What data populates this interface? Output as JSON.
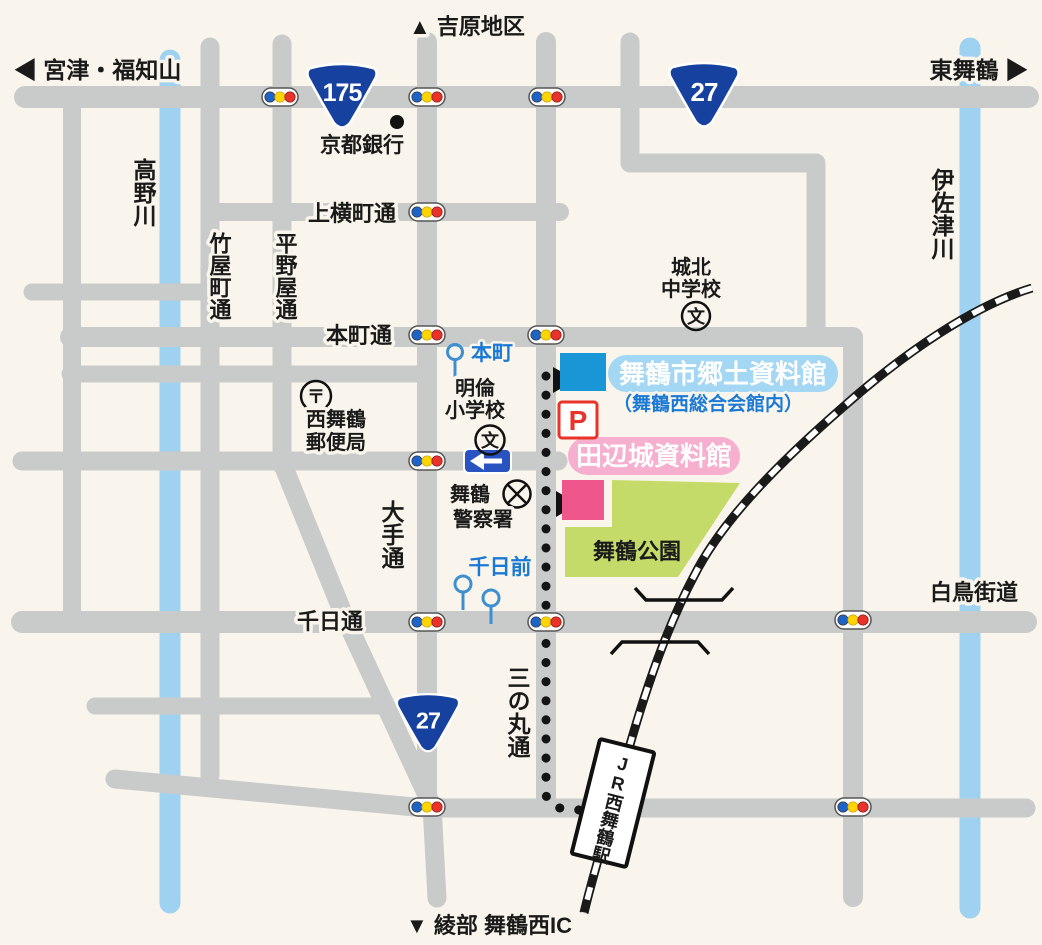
{
  "colors": {
    "background": "#FAF5EC",
    "road_gray": "#C8CBC9",
    "river_blue": "#9ED2F0",
    "park_green": "#C4DB69",
    "railway_black": "#1A1A1A",
    "museum_blue_building": "#1996D5",
    "museum_blue_pill": "#A3D7F3",
    "museum_note_blue": "#1B79D6",
    "tanabe_pink_building": "#EF568C",
    "tanabe_pink_pill": "#F6AFCF",
    "parking_red": "#E8332A",
    "route_shield_blue": "#17419E",
    "signal_blue": "#1E63C8",
    "signal_yellow": "#FFD400",
    "signal_red": "#E8332A",
    "oneway_sign_blue": "#2853C0",
    "tram_stop_blue": "#3E8FD0",
    "label_text": "#1A1A1A"
  },
  "directions": {
    "north": "▲ 吉原地区",
    "west": "◀ 宮津・福知山",
    "east": "東舞鶴 ▶",
    "south": "▼ 綾部 舞鶴西IC"
  },
  "route_shields": {
    "route175": "175",
    "route27_top": "27",
    "route27_bottom": "27"
  },
  "rivers": {
    "takano": "高野川",
    "isazu": "伊佐津川"
  },
  "streets": {
    "kamiyokocho": "上横町通",
    "honmachi": "本町通",
    "takeyacho": "竹屋町通",
    "hiranoya": "平野屋通",
    "ote": "大手通",
    "sennichi": "千日通",
    "sannomaru": "三の丸通",
    "shiratori": "白鳥街道"
  },
  "tram_stops": {
    "honmachi": "本町",
    "sennichimae": "千日前"
  },
  "landmarks": {
    "kyoto_bank": "京都銀行",
    "post_office": [
      "西舞鶴",
      "郵便局"
    ],
    "post_symbol": "〒",
    "meirin_school": [
      "明倫",
      "小学校"
    ],
    "school_symbol": "文",
    "police": [
      "舞鶴",
      "警察署"
    ],
    "johoku_school": [
      "城北",
      "中学校"
    ],
    "park": "舞鶴公園",
    "station": "JR西舞鶴駅"
  },
  "museums": {
    "kyodo_label": "舞鶴市郷土資料館",
    "kyodo_note": "（舞鶴西総合会館内）",
    "tanabe_label": "田辺城資料館",
    "parking_label": "P"
  }
}
